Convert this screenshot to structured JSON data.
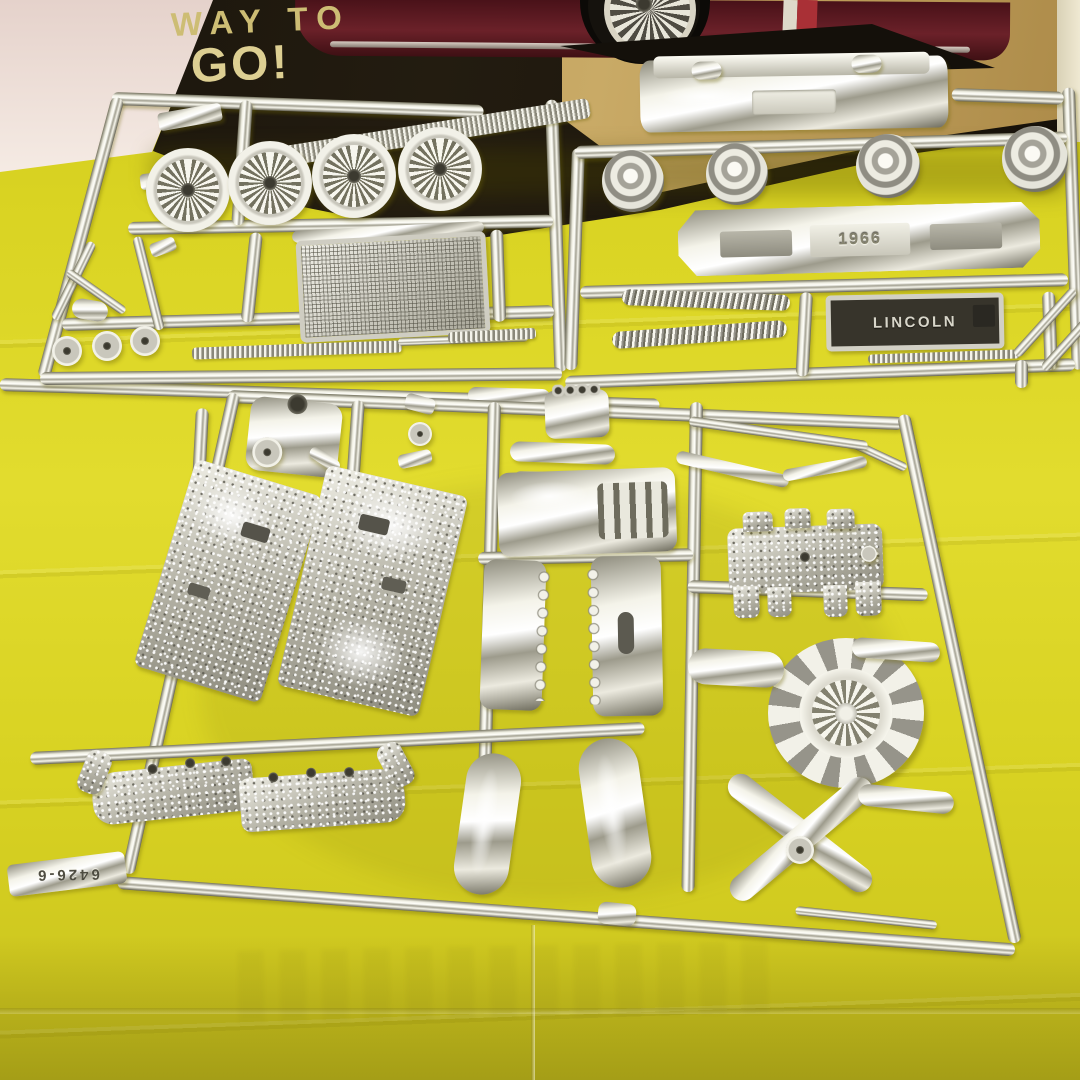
{
  "box_art": {
    "tagline_line1": "WAY TO",
    "tagline_line2": "GO!"
  },
  "embossed_text": {
    "rear_bumper_year": "1966",
    "license_plate": "LINCOLN",
    "mold_number": "6426-6"
  },
  "palette": {
    "paper_yellow": "#d9d322",
    "wall_pink": "#eadbd4",
    "box_black": "#18130b",
    "box_gold": "#bd9c58",
    "car_maroon": "#5c1c23",
    "chrome_light": "#f6f5ec",
    "chrome_shadow": "#6c6a5b",
    "tagline_gold": "#cfc07b"
  }
}
